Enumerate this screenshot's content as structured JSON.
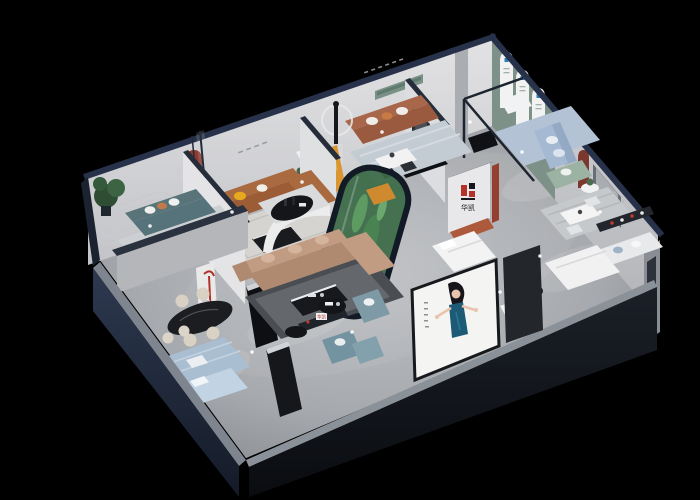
{
  "scene": {
    "type": "3d-isometric-cutaway-render",
    "subject": "furniture showroom dollhouse view, lit rooms on black background",
    "background": "#000000"
  },
  "brand": {
    "logo_text": "华凯",
    "logo_red": "#b5322a",
    "logo_black": "#17171a"
  },
  "palette": {
    "roof_trim": "#27324a",
    "wall_light": "#dcdde0",
    "wall_shade": "#c7c8cb",
    "floor_light": "#b9bbbf",
    "floor_dark": "#8f9296",
    "green_feature_wall": "#7d9188",
    "arch_white": "#f1f2f1",
    "accent_red_niche": "#8e3a30",
    "sofa_teal": "#56727a",
    "sofa_cognac": "#aa6a40",
    "sofa_brown": "#a8674b",
    "sofa_tan": "#c29c82",
    "sofa_blue": "#a5bad2",
    "sofa_sage": "#9cb2a3",
    "armchair_bluegrey": "#7e9aa6",
    "accent_orange": "#d9952f",
    "accent_yellow": "#e7a91f",
    "terracotta": "#ad5a3c",
    "terrarium_green": "#3b6a46",
    "cactus": "#5d9b63",
    "exterior_navy": "#27324a",
    "exterior_charcoal": "#111418",
    "poster_bg": "#f4f4f3",
    "poster_dress": "#1d5a75",
    "skin": "#e8c4ae",
    "rug_blue": "#a9bed1"
  },
  "rooms": [
    {
      "name": "lounge-teal",
      "items": [
        "teal three-seat sofa",
        "striped rug",
        "round white coffee table",
        "potted plant",
        "orange accent chair",
        "panel moulding wall"
      ]
    },
    {
      "name": "lounge-cognac",
      "items": [
        "cognac leather sectional",
        "yellow pillow",
        "black coffee table",
        "red arched niche with figurine",
        "glass partition"
      ]
    },
    {
      "name": "lounge-brown",
      "items": [
        "brown leather sofa",
        "white dining set",
        "sculpture with halo light",
        "orange chaise",
        "green wall niche",
        "wall lettering"
      ]
    },
    {
      "name": "gallery-green",
      "items": [
        "green feature wall",
        "three arched posters",
        "white armchair",
        "light blue sofa",
        "sage sofa",
        "glass partition",
        "black console"
      ]
    },
    {
      "name": "bedroom-display",
      "items": [
        "brand logo wall",
        "white bed",
        "terracotta bench",
        "red pillar"
      ]
    },
    {
      "name": "living-center",
      "items": [
        "tan sectional sofa",
        "black and white coffee table",
        "dark rug",
        "curved white partition",
        "black oval table on platform",
        "cactus terrarium",
        "orange armchair"
      ]
    },
    {
      "name": "dining-corner",
      "items": [
        "black oval dining table",
        "cream stools",
        "red floor lamp shelf",
        "black media cabinet"
      ]
    },
    {
      "name": "bedroom-front",
      "items": [
        "light blue bed",
        "patterned blue rug",
        "long dark sideboard",
        "bar stools",
        "small white table"
      ]
    },
    {
      "name": "seating-front",
      "items": [
        "blue-grey armchairs",
        "ottoman",
        "round black pedestal tables",
        "brand shelf sign"
      ]
    },
    {
      "name": "suite-right",
      "items": [
        "white dining set",
        "striped rug",
        "wall shelf with red products",
        "white sofa",
        "white bed",
        "black round table",
        "white bench",
        "dark red arch niche",
        "grey wall panel"
      ]
    }
  ],
  "poster": {
    "description": "billboard of woman with dark hair in teal halter dress, arms gesturing",
    "vertical_caption_lines": 5
  }
}
